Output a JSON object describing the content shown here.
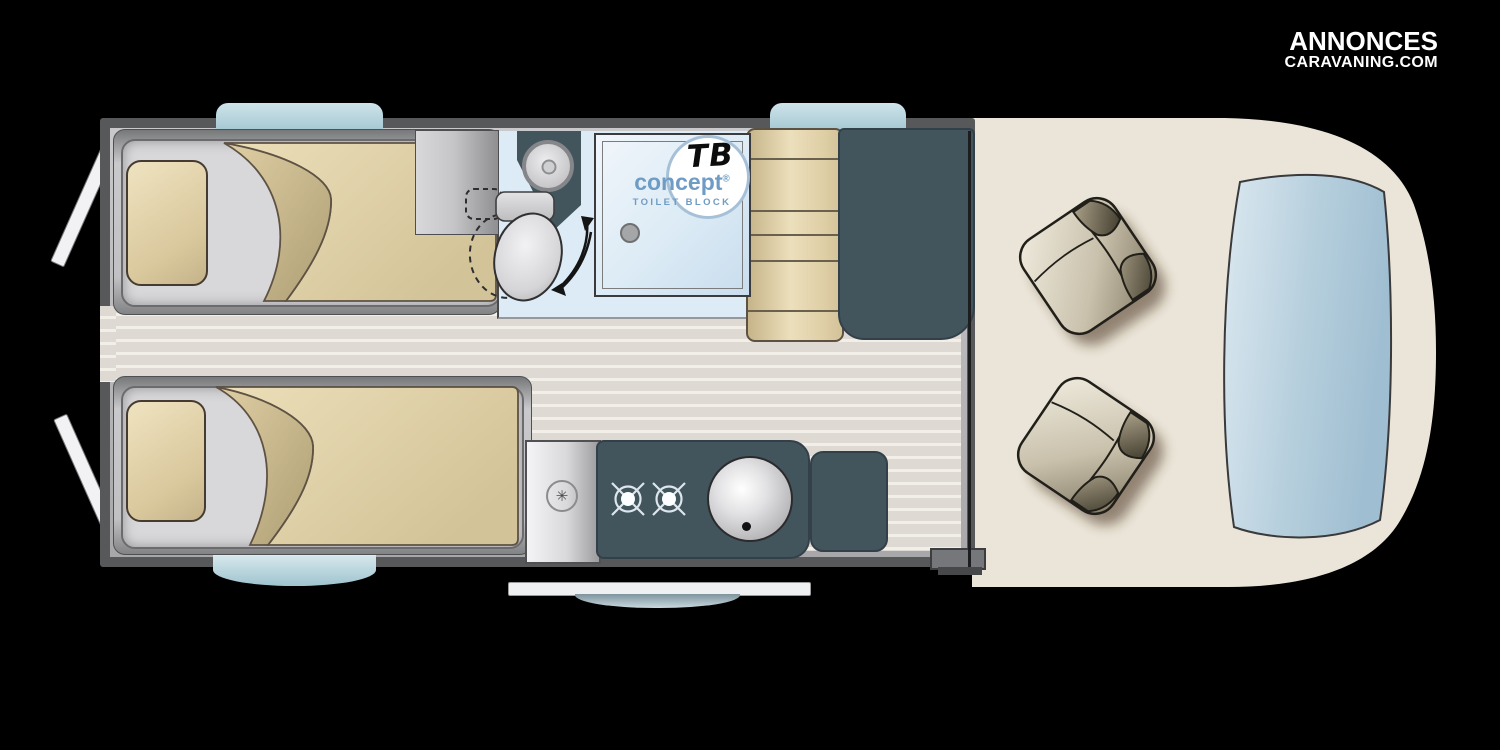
{
  "watermark": {
    "line1": "ANNONCES",
    "line2": "CARAVANING.COM",
    "color": "#ffffff"
  },
  "bathroom": {
    "badge": {
      "initials": "TB",
      "brand": "concept",
      "registered": "®",
      "subtitle": "TOILET BLOCK",
      "accent": "#6f9cc5"
    }
  },
  "kitchen": {
    "appliance_icon_glyph": "✳"
  },
  "colors": {
    "background": "#000000",
    "wall": "#57585a",
    "wall_lining": "#b2b2b4",
    "floor": "#dedad3",
    "floor_stripe": "#f2efe9",
    "bed_platform": "#9b9c9e",
    "mattress": "#d8d8da",
    "bedding_tan": "#e4d6ae",
    "bedding_fold": "#c2b183",
    "bathroom_floor": "#dcebf5",
    "fixture_dark_slate": "#42545c",
    "bench_tan": "#e2d3ab",
    "cab_floor_cream": "#eae5d8",
    "windshield_blue": "#b7cfdd",
    "window_glass": "#b5d3dc",
    "seat_upholstery": "#c9c1ac"
  }
}
